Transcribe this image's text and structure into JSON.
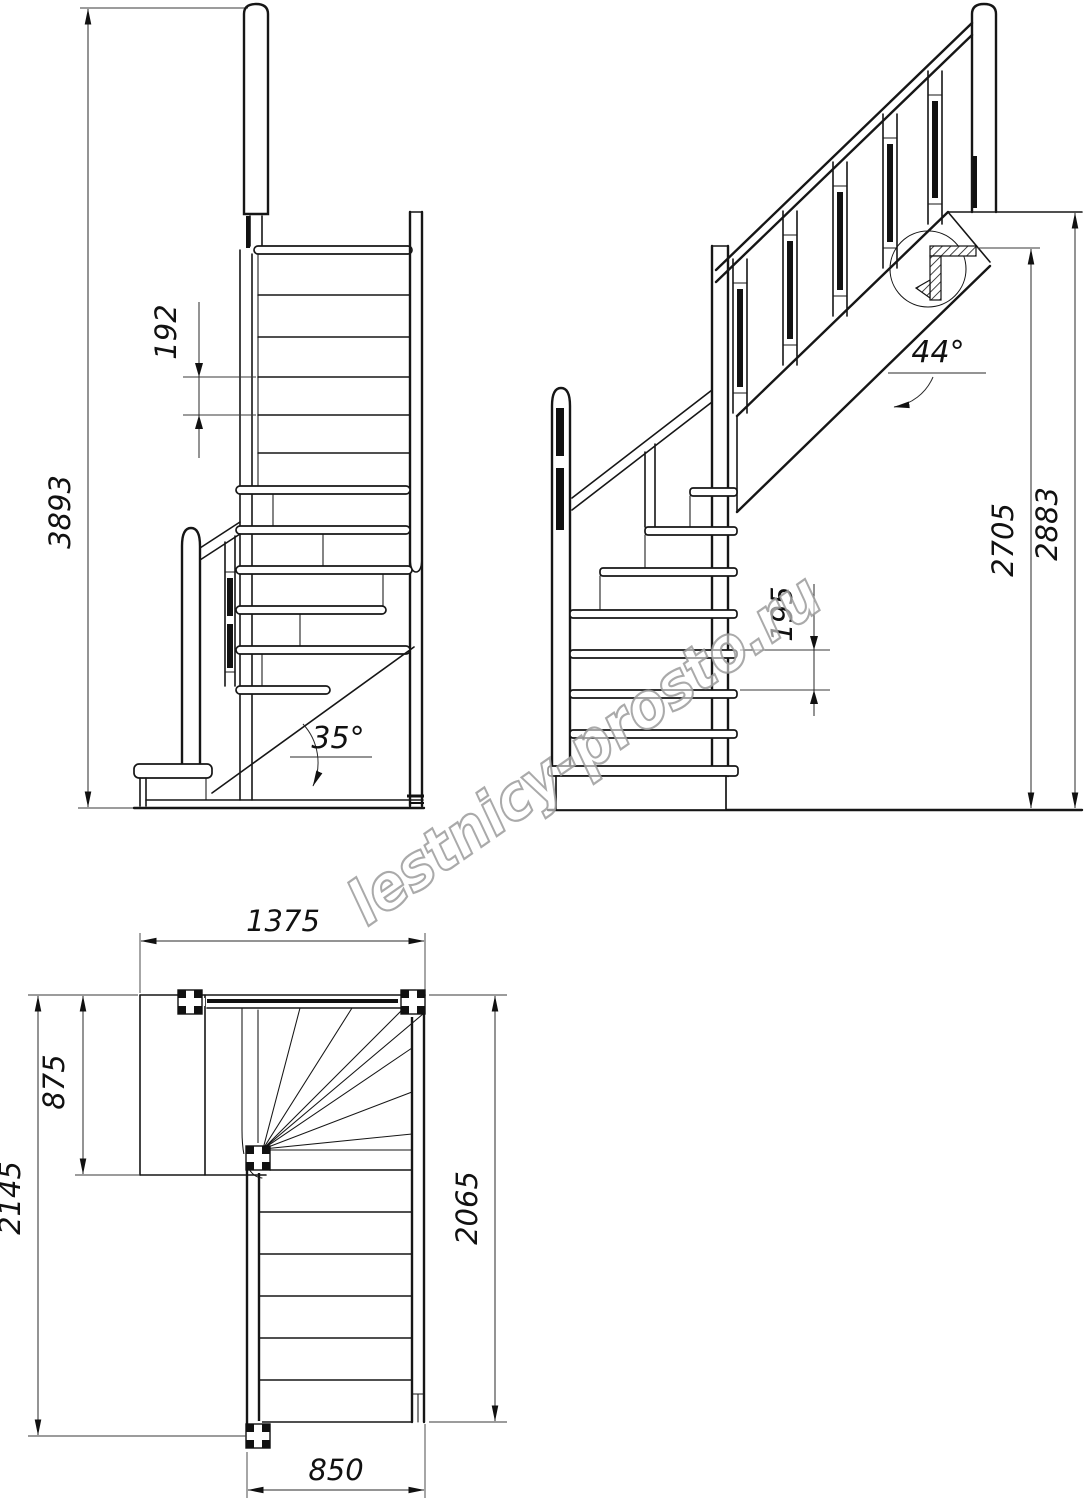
{
  "drawing": {
    "watermark": "lestnicy-prosto.ru",
    "front_view": {
      "total_height": "3893",
      "riser_height": "192",
      "stringer_angle": "35°"
    },
    "side_view": {
      "flight_angle": "44°",
      "riser_height": "195",
      "height_under_floor": "2705",
      "floor_to_floor_height": "2883"
    },
    "plan_view": {
      "upper_flight_span": "1375",
      "landing_depth": "875",
      "overall_depth": "2145",
      "lower_flight_length": "2065",
      "flight_width": "850"
    }
  }
}
